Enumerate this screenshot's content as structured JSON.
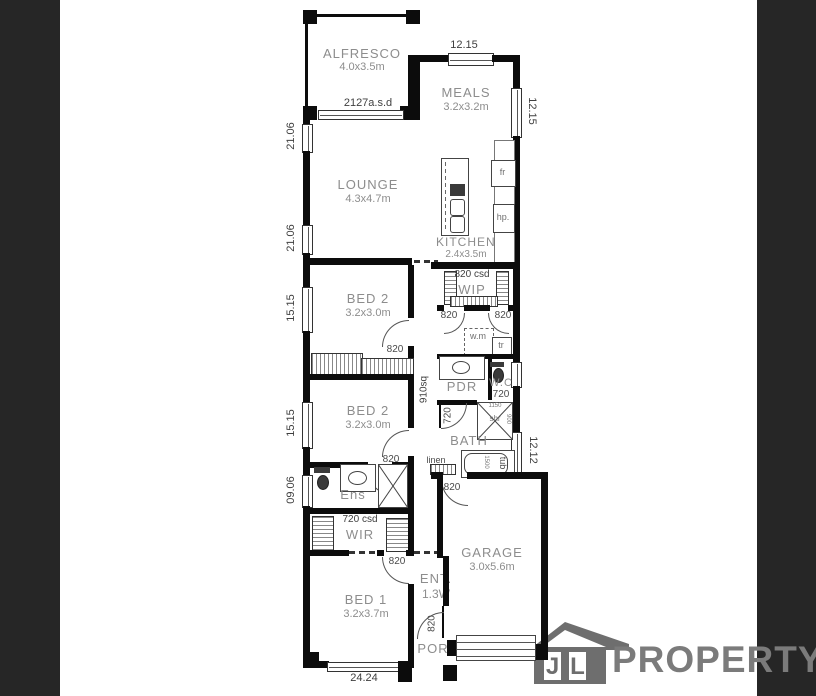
{
  "plan": {
    "alfresco": {
      "name": "ALFRESCO",
      "size": "4.0x3.5m",
      "slider": "2127a.s.d"
    },
    "meals": {
      "name": "MEALS",
      "size": "3.2x3.2m"
    },
    "lounge": {
      "name": "LOUNGE",
      "size": "4.3x4.7m"
    },
    "kitchen": {
      "name": "KITCHEN",
      "size": "2.4x3.5m",
      "fridge": "fr",
      "hotplate": "hp."
    },
    "wip": {
      "name": "WIP",
      "slider": "820 csd",
      "door_left": "820",
      "door_right": "820"
    },
    "laundry": {
      "washer": "w.m",
      "trough": "tr"
    },
    "bed2_upper": {
      "name": "BED 2",
      "size": "3.2x3.0m",
      "door": "820"
    },
    "bed2_lower": {
      "name": "BED 2",
      "size": "3.2x3.0m",
      "door": "820"
    },
    "pdr": {
      "name": "PDR",
      "door": "720"
    },
    "wc": {
      "name": "W.C",
      "door": "720"
    },
    "hall": {
      "dim": "910sq",
      "garage_door": "820"
    },
    "bath": {
      "name": "BATH",
      "shower": "shr",
      "shower_w": "1150",
      "shower_d": "900",
      "tub": "tub",
      "tub_len": "1500",
      "linen": "linen"
    },
    "ens": {
      "name": "Ens"
    },
    "wir": {
      "name": "WIR",
      "slider": "720 csd"
    },
    "bed1": {
      "name": "BED 1",
      "size": "3.2x3.7m",
      "door": "820"
    },
    "entry": {
      "name": "ENT.",
      "size": "1.3W",
      "front_door": "820"
    },
    "garage": {
      "name": "GARAGE",
      "size": "3.0x5.6m"
    },
    "porch": {
      "name": "POR"
    },
    "dims": {
      "top": "12.15",
      "right_upper": "12.15",
      "right_lower": "12.12",
      "left_1": "21.06",
      "left_2": "21.06",
      "left_3": "15.15",
      "left_4": "15.15",
      "left_5": "09.06",
      "bottom": "24.24"
    }
  },
  "logo": {
    "initial_1": "J",
    "initial_2": "L",
    "wordmark": "PROPERTY"
  },
  "colors": {
    "wall": "#0c0c0c",
    "side_bar": "#262626",
    "room_label": "#8d8d8d",
    "dimension": "#3f3f3f",
    "logo_gray": "#6e6e6e"
  }
}
